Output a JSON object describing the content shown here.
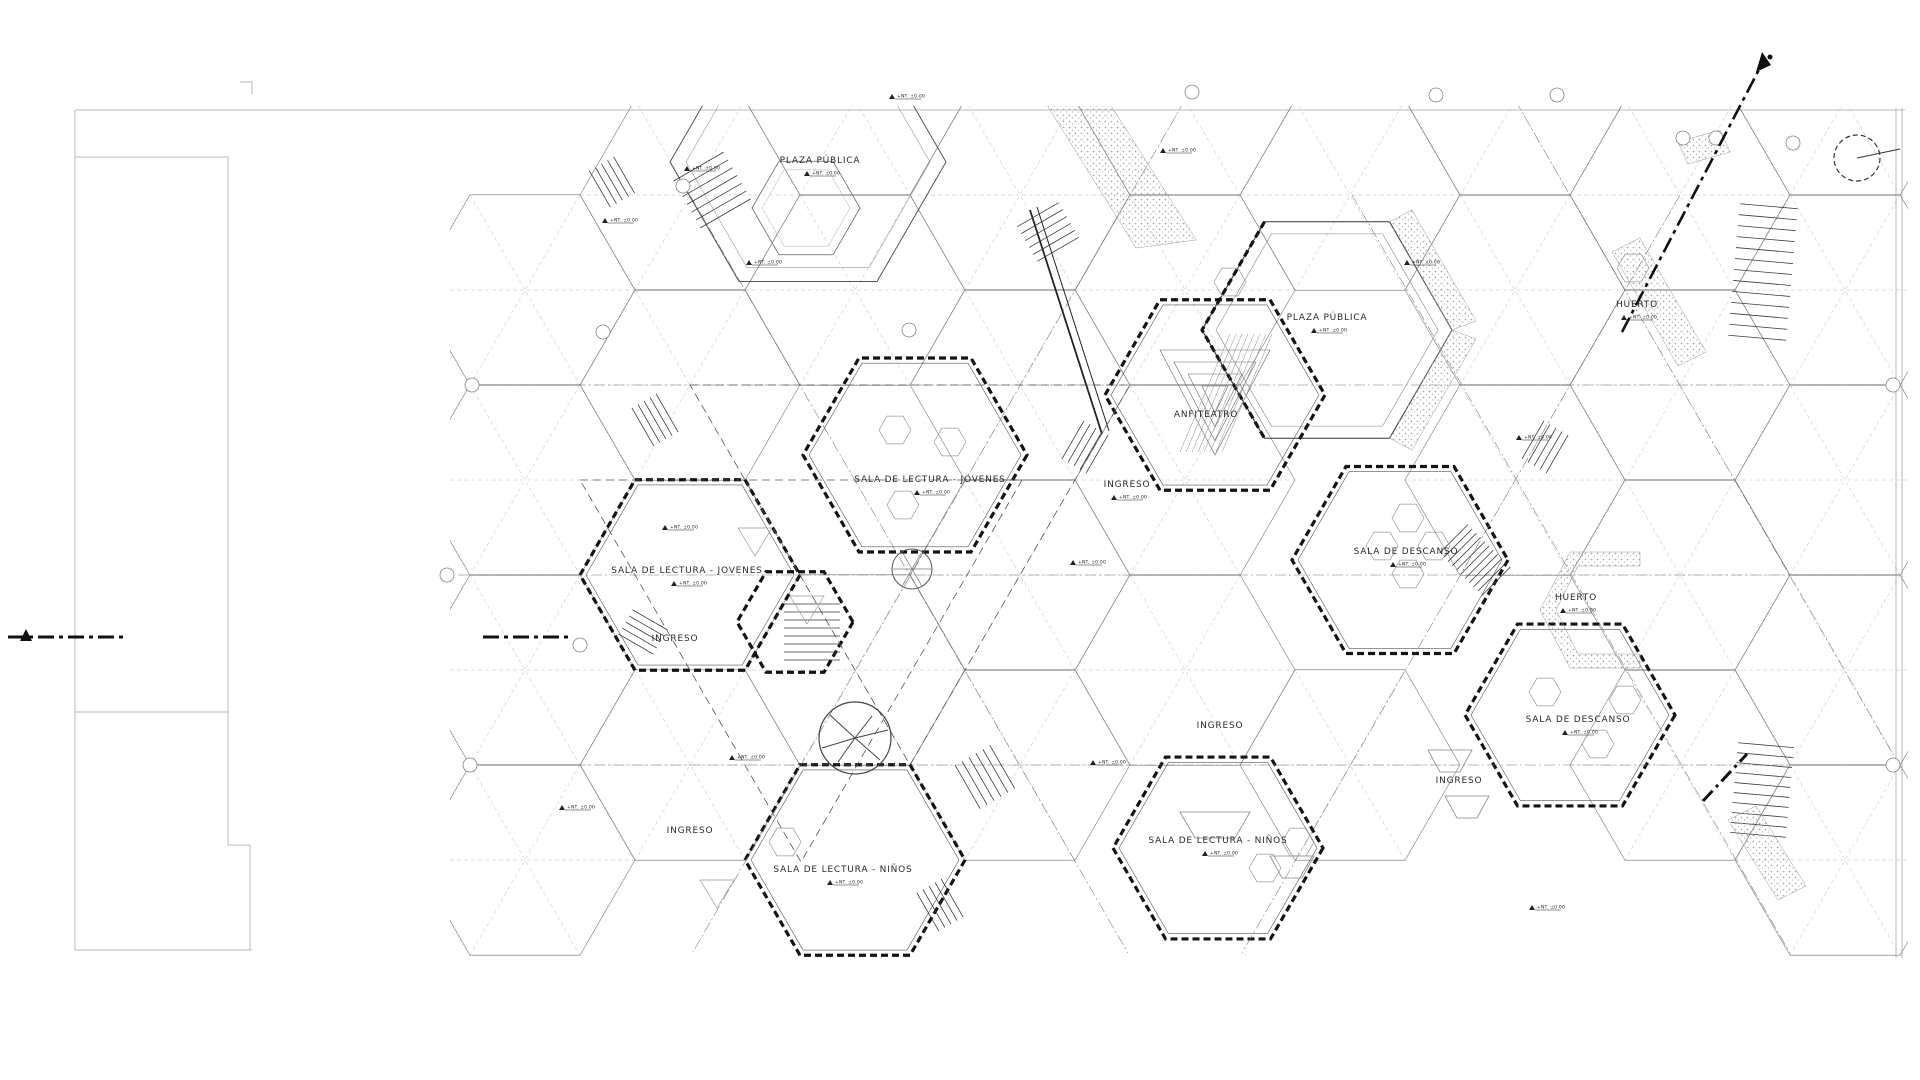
{
  "drawing": {
    "type": "architectural floor plan, hexagonal module library and public plaza",
    "level_marker": "+NT. ±0.00",
    "labels": [
      {
        "id": "plaza-publica-1",
        "text": "PLAZA PÚBLICA"
      },
      {
        "id": "plaza-publica-2",
        "text": "PLAZA PÚBLICA"
      },
      {
        "id": "anfiteatro",
        "text": "ANFITEATRO"
      },
      {
        "id": "sala-lectura-jovenes-1",
        "text": "SALA DE LECTURA - JOVENES"
      },
      {
        "id": "ingreso-1",
        "text": "INGRESO"
      },
      {
        "id": "sala-lectura-jovenes-2",
        "text": "SALA DE LECTURA - JOVENES"
      },
      {
        "id": "ingreso-2",
        "text": "INGRESO"
      },
      {
        "id": "sala-descanso-1",
        "text": "SALA DE DESCANSO"
      },
      {
        "id": "huerto-1",
        "text": "HUERTO"
      },
      {
        "id": "huerto-2",
        "text": "HUERTO"
      },
      {
        "id": "sala-descanso-2",
        "text": "SALA DE DESCANSO"
      },
      {
        "id": "ingreso-3",
        "text": "INGRESO"
      },
      {
        "id": "ingreso-4",
        "text": "INGRESO"
      },
      {
        "id": "sala-lectura-ninos-1",
        "text": "SALA DE LECTURA - NIÑOS"
      },
      {
        "id": "sala-lectura-ninos-2",
        "text": "SALA DE LECTURA - NIÑOS"
      },
      {
        "id": "ingreso-5",
        "text": "INGRESO"
      },
      {
        "id": "huerto-3",
        "text": "HUERTO"
      }
    ],
    "colors": {
      "paper": "#ffffff",
      "ink": "#141414",
      "line_gray": "#8a8a8a",
      "stipple": "#aaaaaa"
    }
  }
}
